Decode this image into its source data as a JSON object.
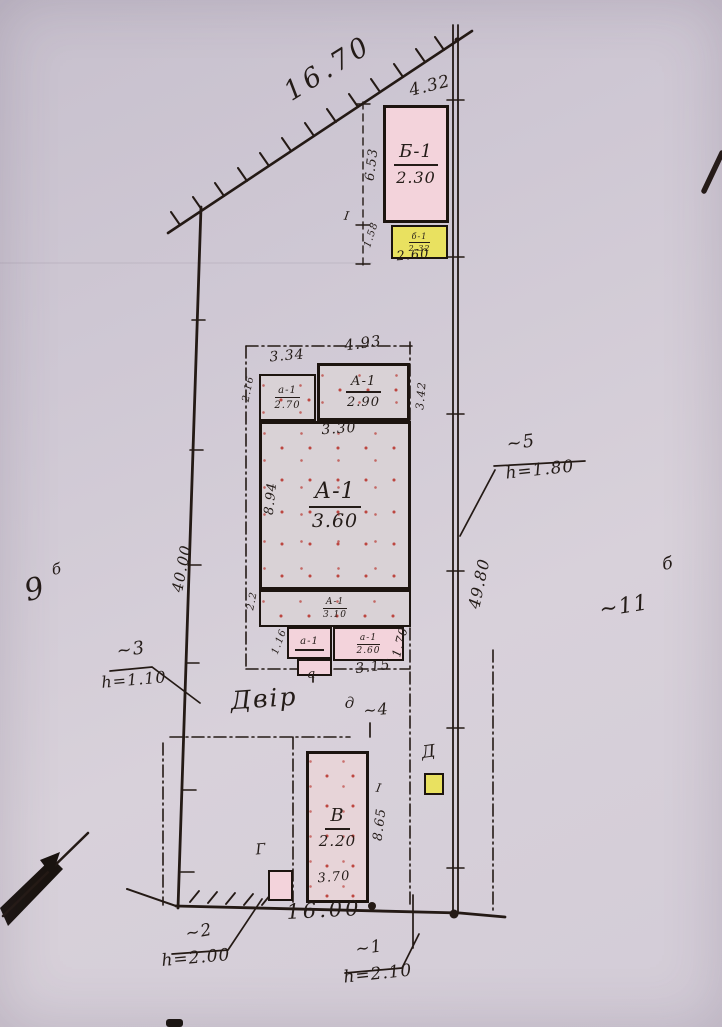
{
  "boundaries": {
    "top": "16.70",
    "top_right": "4.32",
    "left": "40.00",
    "right": "49.80",
    "bottom": "16.00"
  },
  "neighbors": {
    "left_num": "9",
    "left_sup": "б",
    "right_num": "~11",
    "right_sup": "б"
  },
  "yard_label": "Двір",
  "buildings": {
    "b1": {
      "name": "Б-1",
      "height": "2.30"
    },
    "b1_annex": {
      "name": "б-1",
      "height": "2.32"
    },
    "a1_wing_left": {
      "name": "а-1",
      "height": "2.70"
    },
    "a1_wing_right": {
      "name": "А-1",
      "height": "2.90"
    },
    "a1_main": {
      "name": "А-1",
      "height": "3.60"
    },
    "a1_rear": {
      "name": "А-1",
      "height": "3.10"
    },
    "porch_left": {
      "name": "а-1"
    },
    "porch_right": {
      "name": "а-1",
      "height": "2.60"
    },
    "v": {
      "name": "В",
      "height": "2.20"
    },
    "d": {
      "name": "Д"
    },
    "g": {
      "name": "Г"
    }
  },
  "dims": {
    "b1_side": "6.53",
    "annex_side": "1.58",
    "annex_width": "2.60",
    "wing_left_width": "3.34",
    "wing_right_width": "4.93",
    "wing_left_side": "2.16",
    "wing_right_side": "3.42",
    "main_width": "3.30",
    "main_side": "8.94",
    "rear_side": "2.2",
    "porch_left_side": "1.16",
    "porch_right_side": "1.70",
    "porch_width": "3.15",
    "v_side": "8.65",
    "v_width": "3.70"
  },
  "fence_notes": {
    "n1": {
      "num": "~1",
      "height": "h=2.10"
    },
    "n2": {
      "num": "~2",
      "height": "h=2.00"
    },
    "n3": {
      "num": "~3",
      "height": "h=1.10"
    },
    "n4": {
      "num": "~4"
    },
    "n5": {
      "num": "~5",
      "height": "h=1.80"
    }
  },
  "marks": {
    "tick_top": "І",
    "tick_v": "І",
    "porch_letter": "а",
    "gate_letter": "д"
  },
  "colors": {
    "ink": "#241a15",
    "pink_building": "#f3d3db",
    "yellow_building": "#e9e160",
    "stipple_red": "#b72e26",
    "paper": "#d4cdd8"
  }
}
